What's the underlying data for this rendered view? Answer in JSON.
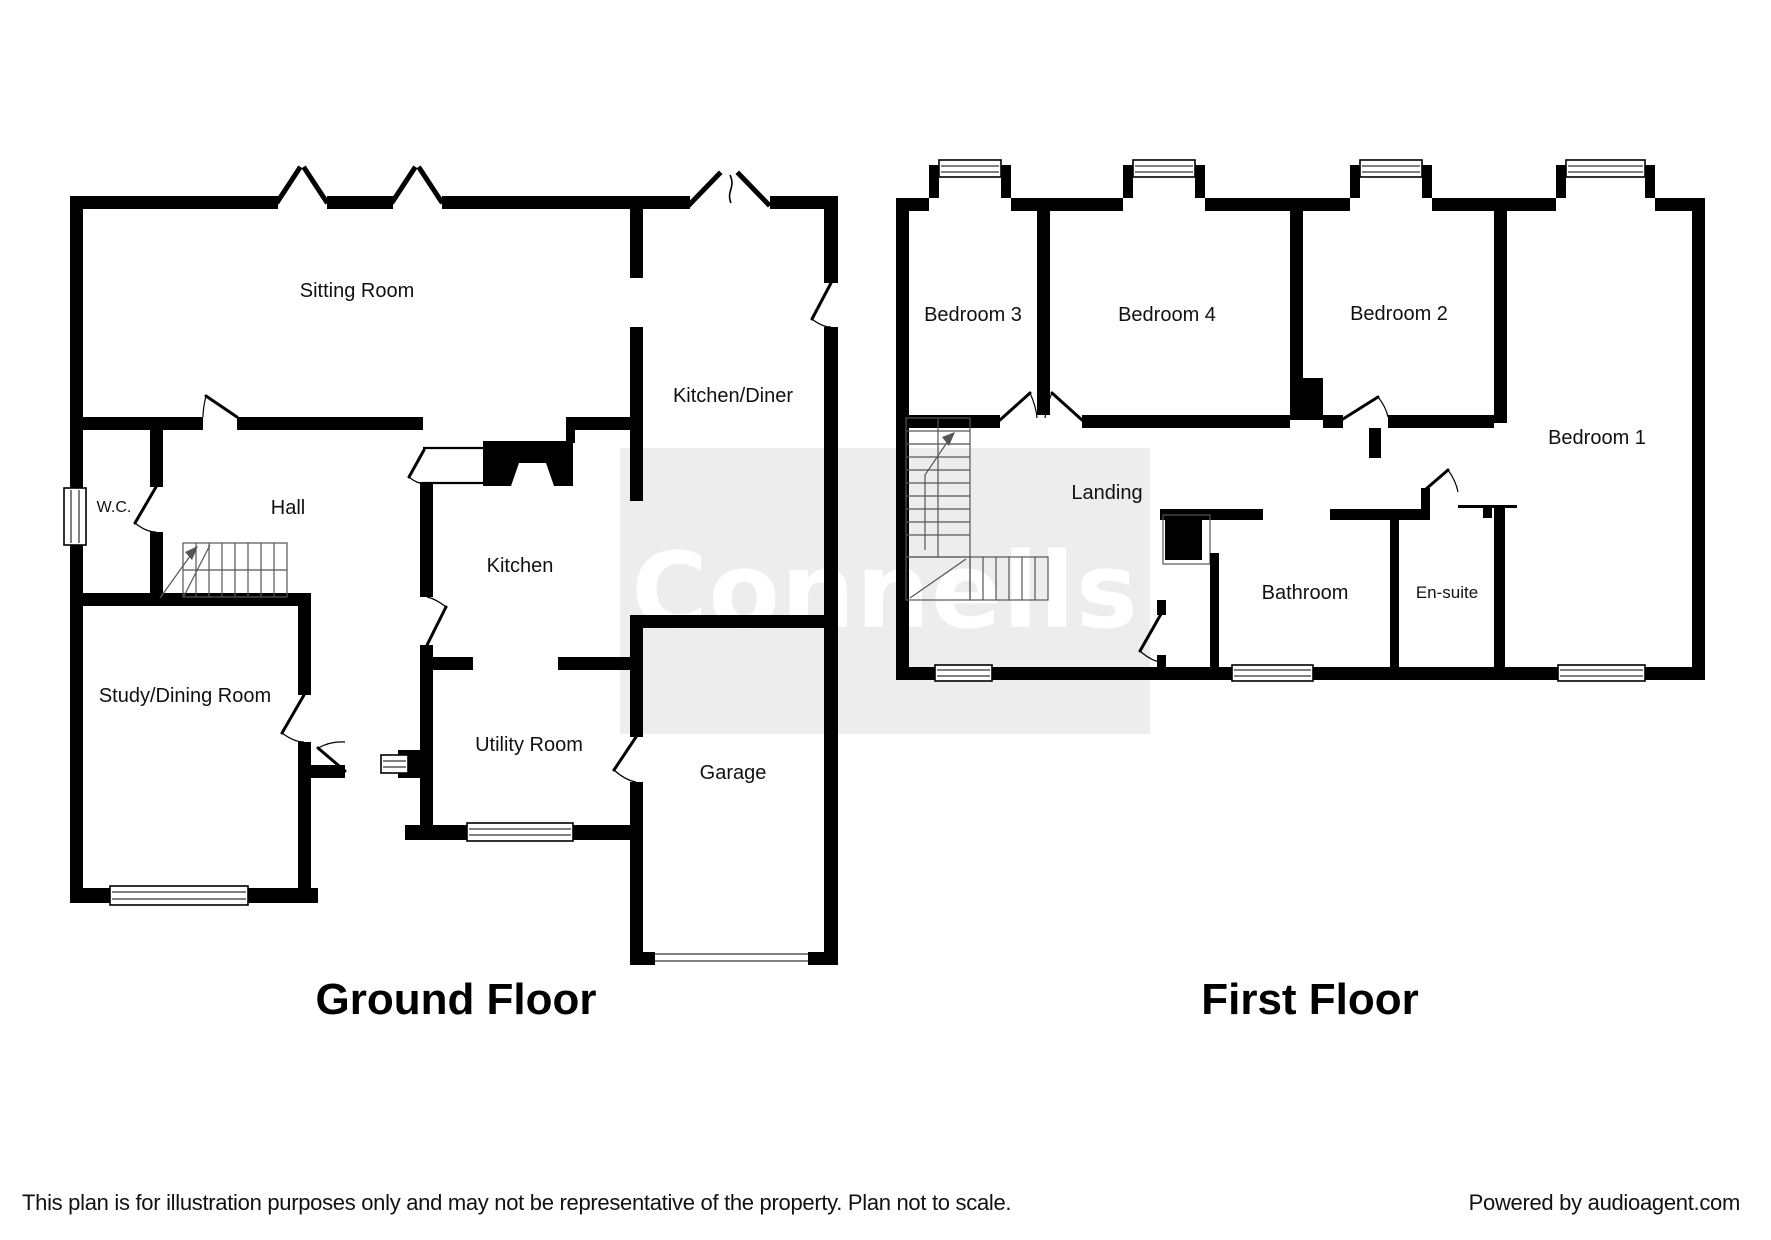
{
  "watermark_text": "Connells",
  "ground": {
    "title": "Ground Floor",
    "rooms": [
      {
        "name": "Sitting Room"
      },
      {
        "name": "Kitchen/Diner"
      },
      {
        "name": "W.C."
      },
      {
        "name": "Hall"
      },
      {
        "name": "Kitchen"
      },
      {
        "name": "Study/Dining Room"
      },
      {
        "name": "Utility Room"
      },
      {
        "name": "Garage"
      }
    ]
  },
  "first": {
    "title": "First Floor",
    "rooms": [
      {
        "name": "Bedroom 3"
      },
      {
        "name": "Bedroom 4"
      },
      {
        "name": "Bedroom 2"
      },
      {
        "name": "Bedroom 1"
      },
      {
        "name": "Landing"
      },
      {
        "name": "Bathroom"
      },
      {
        "name": "En-suite"
      }
    ]
  },
  "footer": {
    "disclaimer": "This plan is for illustration purposes only and may not be representative of the property. Plan not to scale.",
    "credit": "Powered by audioagent.com"
  },
  "colors": {
    "wall": "#000000",
    "watermark_bg": "#ededed",
    "watermark_text": "#ffffff"
  }
}
